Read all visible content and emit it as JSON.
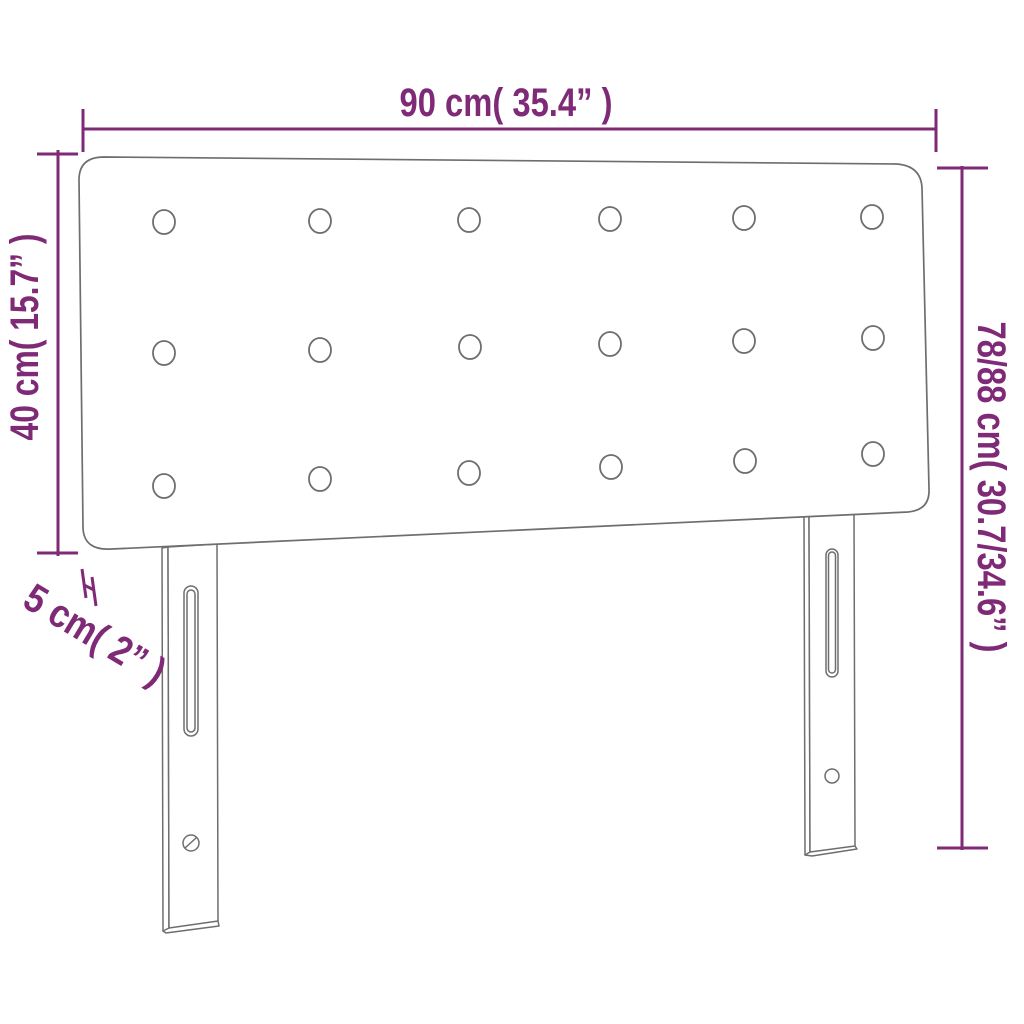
{
  "diagram": {
    "type": "product-dimension-diagram",
    "product": "upholstered headboard with legs",
    "colors": {
      "dimension_annotation": "#7e2a76",
      "product_outline": "#6e6e6e",
      "background": "#ffffff"
    },
    "dimensions": {
      "width_label": "90 cm( 35.4” )",
      "panel_height_label": "40 cm( 15.7” )",
      "depth_label": "5 cm( 2” )",
      "total_height_label": "78/88 cm( 30.7/34.6” )"
    },
    "features": {
      "tuft_button_rows": 3,
      "tuft_buttons_per_row": 6,
      "legs": 2,
      "leg_slots": 2,
      "leg_screw_holes": 2
    }
  }
}
